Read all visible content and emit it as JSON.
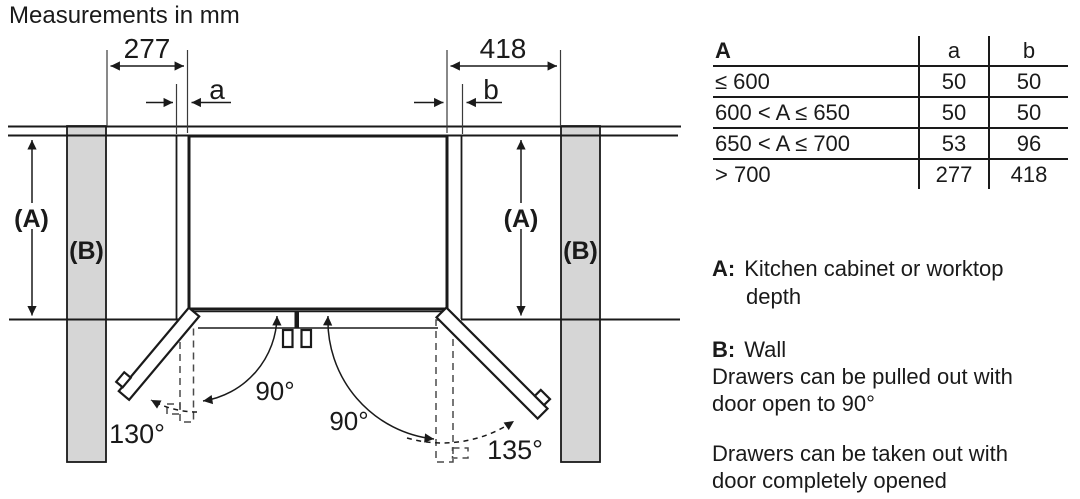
{
  "title": "Measurements in mm",
  "diagram": {
    "dim_left": "277",
    "dim_right": "418",
    "gap_left_label": "a",
    "gap_right_label": "b",
    "depth_label": "(A)",
    "wall_label": "(B)",
    "angle_left_90": "90°",
    "angle_right_90": "90°",
    "angle_left_max": "130°",
    "angle_right_max": "135°"
  },
  "table": {
    "header": {
      "range": "A",
      "a": "a",
      "b": "b"
    },
    "rows": [
      {
        "range": "≤ 600",
        "a": "50",
        "b": "50"
      },
      {
        "range": "600 < A ≤ 650",
        "a": "50",
        "b": "50"
      },
      {
        "range": "650 < A ≤ 700",
        "a": "53",
        "b": "96"
      },
      {
        "range": "> 700",
        "a": "277",
        "b": "418"
      }
    ]
  },
  "notes": {
    "a_label": "A:",
    "a_line1": "Kitchen cabinet or worktop",
    "a_line2": "depth",
    "b_label": "B:",
    "b_text": "Wall",
    "pull_line1": "Drawers can be pulled out with",
    "pull_line2": "door open to 90°",
    "take_line1": "Drawers can be taken out with",
    "take_line2": "door completely opened"
  }
}
